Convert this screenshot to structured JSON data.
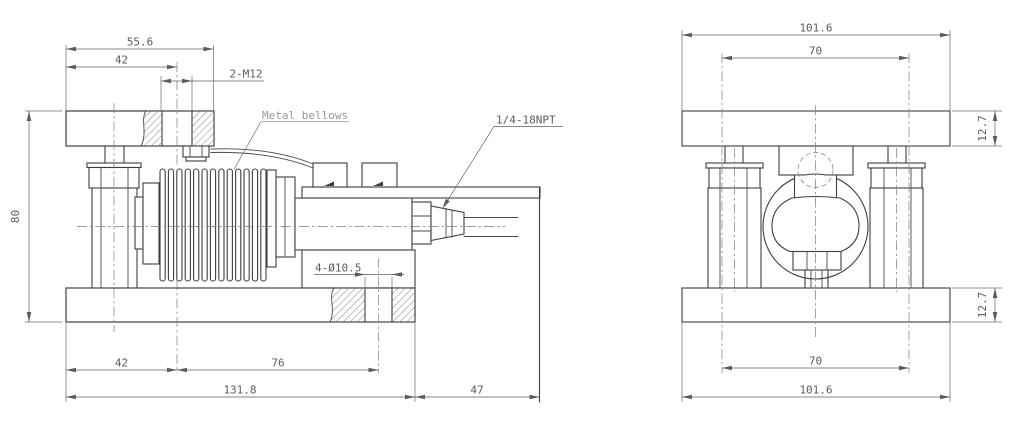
{
  "drawing_type": "technical-drawing",
  "side_view": {
    "dim_top_width": "55.6",
    "dim_top_offset": "42",
    "dim_thread": "2-M12",
    "label_bellows": "Metal bellows",
    "label_conduit": "1/4-18NPT",
    "dim_height": "80",
    "label_holes": "4-Ø10.5",
    "dim_base_left": "42",
    "dim_base_mid": "76",
    "dim_base_total": "131.8",
    "dim_overhang": "47"
  },
  "front_view": {
    "dim_width_top": "101.6",
    "dim_spacing_top": "70",
    "dim_thick_top": "12.7",
    "dim_spacing_bottom": "70",
    "dim_width_bottom": "101.6",
    "dim_thick_bottom": "12.7"
  },
  "colors": {
    "outline": "#3e3e3e",
    "thin_line": "#6f6f6f",
    "text": "#5c5c5c",
    "light_label": "#969696",
    "background": "#ffffff"
  }
}
